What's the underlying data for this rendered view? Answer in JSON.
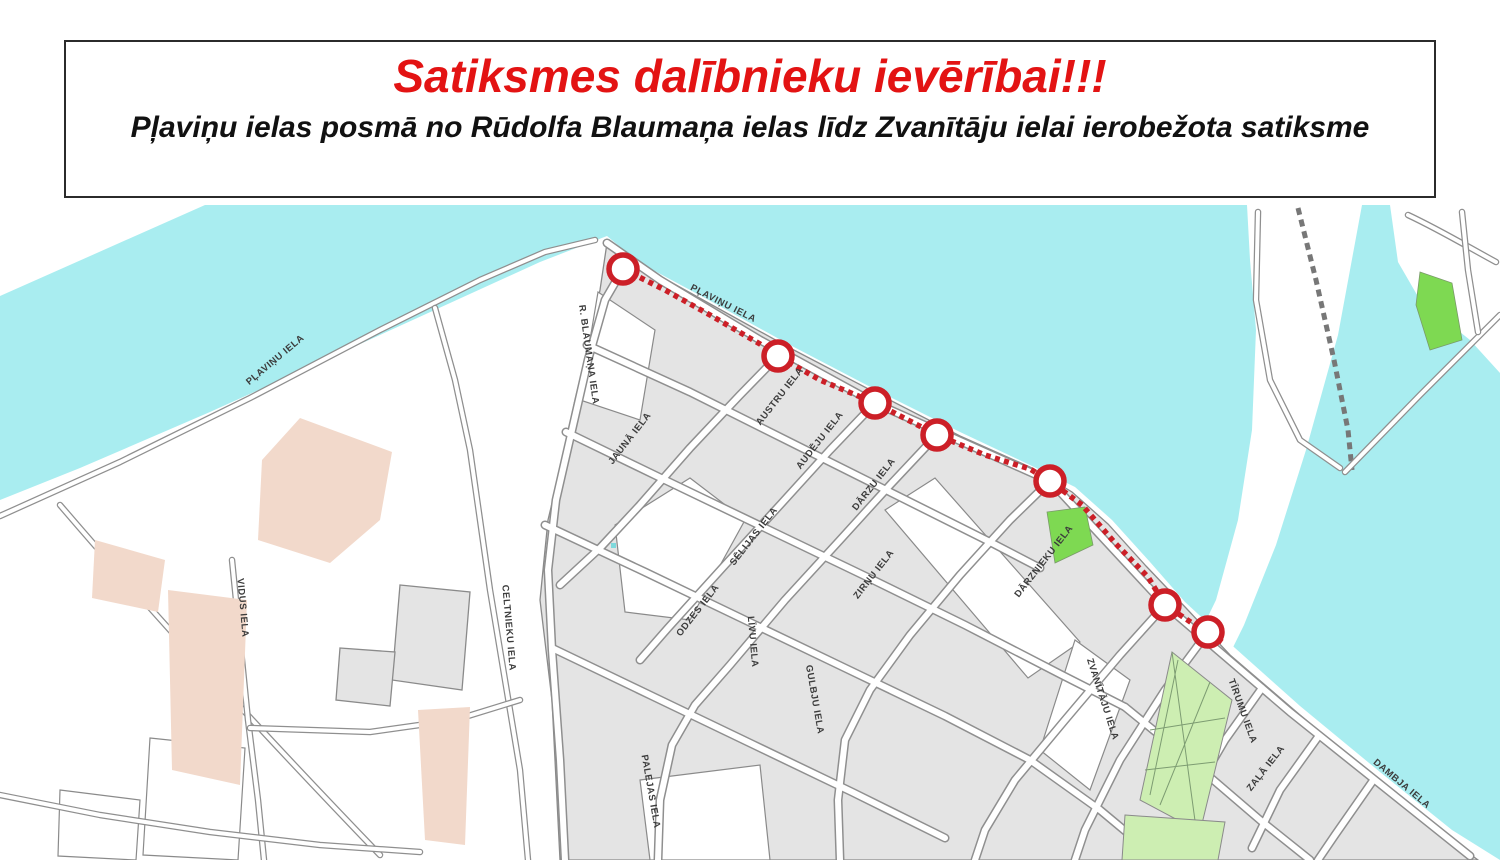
{
  "header": {
    "title": "Satiksmes dalībnieku ievērībai!!!",
    "subtitle": "Pļaviņu ielas posmā no Rūdolfa Blaumaņa ielas līdz Zvanītāju ielai ierobežota satiksme"
  },
  "map": {
    "colors": {
      "title_red": "#e31313",
      "water": "#a9edf0",
      "block_gray": "#e4e4e4",
      "tan_building": "#f2d9cb",
      "green_bright": "#7ed952",
      "green_light": "#cdeeb2",
      "route_red": "#cc1f27"
    },
    "route": {
      "description": "restricted traffic section along Plavinu iela",
      "path_points": [
        [
          623,
          269
        ],
        [
          665,
          290
        ],
        [
          710,
          315
        ],
        [
          760,
          344
        ],
        [
          778,
          356
        ],
        [
          820,
          380
        ],
        [
          875,
          403
        ],
        [
          937,
          435
        ],
        [
          985,
          455
        ],
        [
          1030,
          469
        ],
        [
          1050,
          481
        ],
        [
          1082,
          505
        ],
        [
          1115,
          543
        ],
        [
          1148,
          577
        ],
        [
          1165,
          605
        ],
        [
          1195,
          625
        ],
        [
          1208,
          632
        ],
        [
          1222,
          642
        ]
      ],
      "markers": [
        [
          623,
          269
        ],
        [
          778,
          356
        ],
        [
          875,
          403
        ],
        [
          937,
          435
        ],
        [
          1050,
          481
        ],
        [
          1165,
          605
        ],
        [
          1208,
          632
        ]
      ],
      "marker_radius": 14
    },
    "street_labels": [
      {
        "t": "PĻAVIŅU IELA",
        "x": 277,
        "y": 362,
        "r": -40
      },
      {
        "t": "PĻAVIŅU IELA",
        "x": 722,
        "y": 306,
        "r": 27
      },
      {
        "t": "R. BLAUMAŅA IELA",
        "x": 586,
        "y": 355,
        "r": 82
      },
      {
        "t": "JAUNĀ IELA",
        "x": 632,
        "y": 440,
        "r": -52
      },
      {
        "t": "AUSTRU IELA",
        "x": 782,
        "y": 398,
        "r": -52
      },
      {
        "t": "AUDĒJU IELA",
        "x": 822,
        "y": 442,
        "r": -52
      },
      {
        "t": "SĒLIJAS IELA",
        "x": 756,
        "y": 538,
        "r": -52
      },
      {
        "t": "ODZES IELA",
        "x": 700,
        "y": 612,
        "r": -52
      },
      {
        "t": "LĪVU IELA",
        "x": 750,
        "y": 642,
        "r": 85
      },
      {
        "t": "GULBJU IELA",
        "x": 812,
        "y": 700,
        "r": 80
      },
      {
        "t": "DĀRZU IELA",
        "x": 876,
        "y": 486,
        "r": -52
      },
      {
        "t": "ZIRŅU IELA",
        "x": 876,
        "y": 576,
        "r": -52
      },
      {
        "t": "DĀRZNIEKU IELA",
        "x": 1046,
        "y": 563,
        "r": -52
      },
      {
        "t": "ZVANĪTĀJU IELA",
        "x": 1100,
        "y": 700,
        "r": 72
      },
      {
        "t": "VIDUS IELA",
        "x": 240,
        "y": 608,
        "r": 85
      },
      {
        "t": "CELTNIEKU IELA",
        "x": 506,
        "y": 628,
        "r": 85
      },
      {
        "t": "PALEJAS IELA",
        "x": 648,
        "y": 792,
        "r": 80
      },
      {
        "t": "TĪRUMU IELA",
        "x": 1240,
        "y": 712,
        "r": 70
      },
      {
        "t": "ZAĻĀ IELA",
        "x": 1268,
        "y": 770,
        "r": -52
      },
      {
        "t": "DAMBJA IELA",
        "x": 1400,
        "y": 786,
        "r": 40
      }
    ]
  }
}
